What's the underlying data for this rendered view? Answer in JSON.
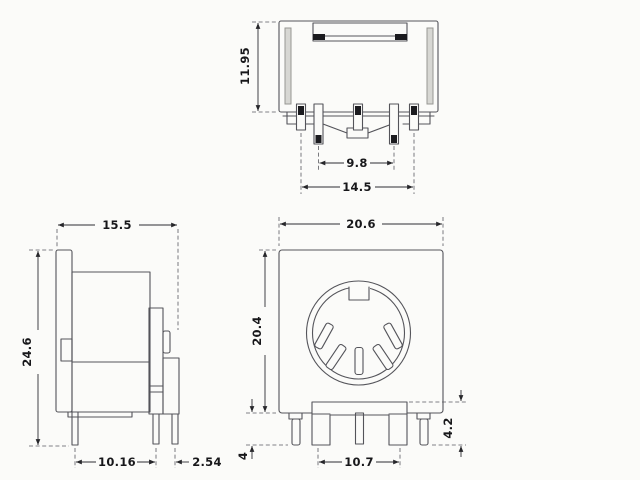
{
  "drawing": {
    "title": "5-pin DIN socket orthographic views",
    "background": "#fbfbf9",
    "line_color": "#54545a",
    "text_color": "#17171a",
    "views": {
      "top": {
        "name": "top-view",
        "dimensions": {
          "body_height": "11.95",
          "inner_pin_pitch": "9.8",
          "outer_pin_pitch": "14.5"
        }
      },
      "side": {
        "name": "side-view",
        "dimensions": {
          "depth": "15.5",
          "overall_height": "24.6",
          "pin_offset": "10.16",
          "pin_pitch": "2.54"
        }
      },
      "front": {
        "name": "front-view",
        "dimensions": {
          "body_width": "20.6",
          "body_height": "20.4",
          "shield_tab_pitch": "10.7",
          "pin_length": "4",
          "shield_tab_length": "4.2"
        }
      }
    }
  }
}
